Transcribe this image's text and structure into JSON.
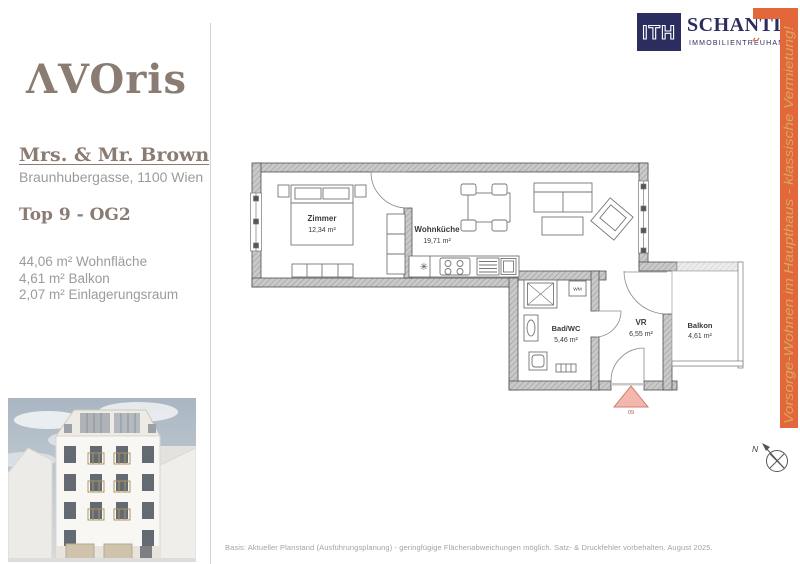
{
  "branding": {
    "avoris_logo": "ΛVOris",
    "brand_color": "#8b7c73"
  },
  "header": {
    "ith_logo": "ITH",
    "company": "SCHANTL",
    "company_subtitle": "IMMOBILIENTREUHAND",
    "navy_color": "#2b2d5e",
    "accent_color": "#e2673a"
  },
  "project": {
    "client": "Mrs. & Mr. Brown",
    "address": "Braunhubergasse, 1100 Wien",
    "unit": "Top 9 - OG2",
    "areas": [
      "44,06 m² Wohnfläche",
      "4,61 m² Balkon",
      "2,07 m² Einlagerungsraum"
    ]
  },
  "ribbon": {
    "text": "Vorsorge-Wohnen im Haupthaus - klassische Vermietung!",
    "bar_color": "#e2673a",
    "text_color": "#d8a75f"
  },
  "floorplan": {
    "rooms": [
      {
        "name": "Zimmer",
        "area": "12,34 m²"
      },
      {
        "name": "Wohnküche",
        "area": "19,71 m²"
      },
      {
        "name": "Bad/WC",
        "area": "5,46 m²"
      },
      {
        "name": "VR",
        "area": "6,55 m²"
      },
      {
        "name": "Balkon",
        "area": "4,61 m²"
      }
    ],
    "washing_machine_label": "WM",
    "kitchen_symbol": "✳",
    "entrance_number": "09",
    "entrance_marker_color": "#f4b7ae",
    "compass_label": "N"
  },
  "footer": {
    "disclaimer": "Basis: Aktueller Planstand (Ausführungsplanung) - geringfügige Flächenabweichungen möglich. Satz- & Druckfehler vorbehalten. August 2025."
  }
}
